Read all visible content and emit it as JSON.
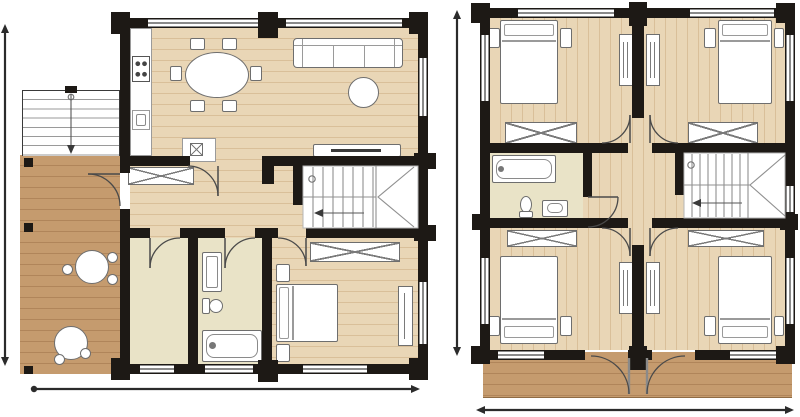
{
  "document": {
    "type": "architectural-floor-plan",
    "text_visible": false,
    "plan_count": 2
  },
  "colors": {
    "background": "#ffffff",
    "wall": "#1d1915",
    "wood_floor": "#e9d6b6",
    "wood_plank_line": "#d9bf99",
    "terrace_wood": "#c59b6e",
    "terrace_plank_line": "#b0855a",
    "tile_floor": "#e9e3c7",
    "furniture_outline": "#6e6e6e",
    "window_frame": "#8a8a8a",
    "stair_line": "#909090",
    "dimension_line": "#2b2b2b"
  },
  "plans": [
    {
      "name": "ground-floor",
      "position": "left",
      "rooms": [
        "kitchen-dining",
        "living-room",
        "hallway",
        "utility-room",
        "bathroom",
        "bedroom",
        "stairwell",
        "terrace",
        "exterior-stairs"
      ],
      "furniture": [
        "kitchen-counter",
        "stove",
        "kitchen-sink",
        "kitchen-peninsula-hob",
        "dining-table-with-6-chairs",
        "sofa-3-seat",
        "round-coffee-table",
        "tv-sideboard",
        "u-staircase",
        "hall-wardrobe",
        "bedroom-wardrobe",
        "bathroom-vanity",
        "toilet",
        "bathtub",
        "double-bed",
        "nightstand",
        "nightstand",
        "dresser",
        "terrace-round-table",
        "terrace-round-table"
      ],
      "dimension_lines": [
        "left-vertical-extent",
        "bottom-horizontal-extent"
      ]
    },
    {
      "name": "upper-floor",
      "position": "right",
      "rooms": [
        "bedroom-top-left",
        "bedroom-top-right",
        "bedroom-bottom-left",
        "bedroom-bottom-right",
        "central-hallway",
        "bathroom",
        "stairwell",
        "balcony"
      ],
      "furniture": [
        "double-bed",
        "double-bed",
        "double-bed",
        "double-bed",
        "nightstands",
        "wardrobe",
        "wardrobe",
        "wardrobe",
        "wardrobe",
        "closet-pair-top",
        "closet-pair-bottom",
        "bathtub",
        "toilet",
        "washbasin",
        "u-staircase"
      ],
      "dimension_lines": [
        "center-vertical-extent",
        "bottom-horizontal-extent"
      ]
    }
  ]
}
